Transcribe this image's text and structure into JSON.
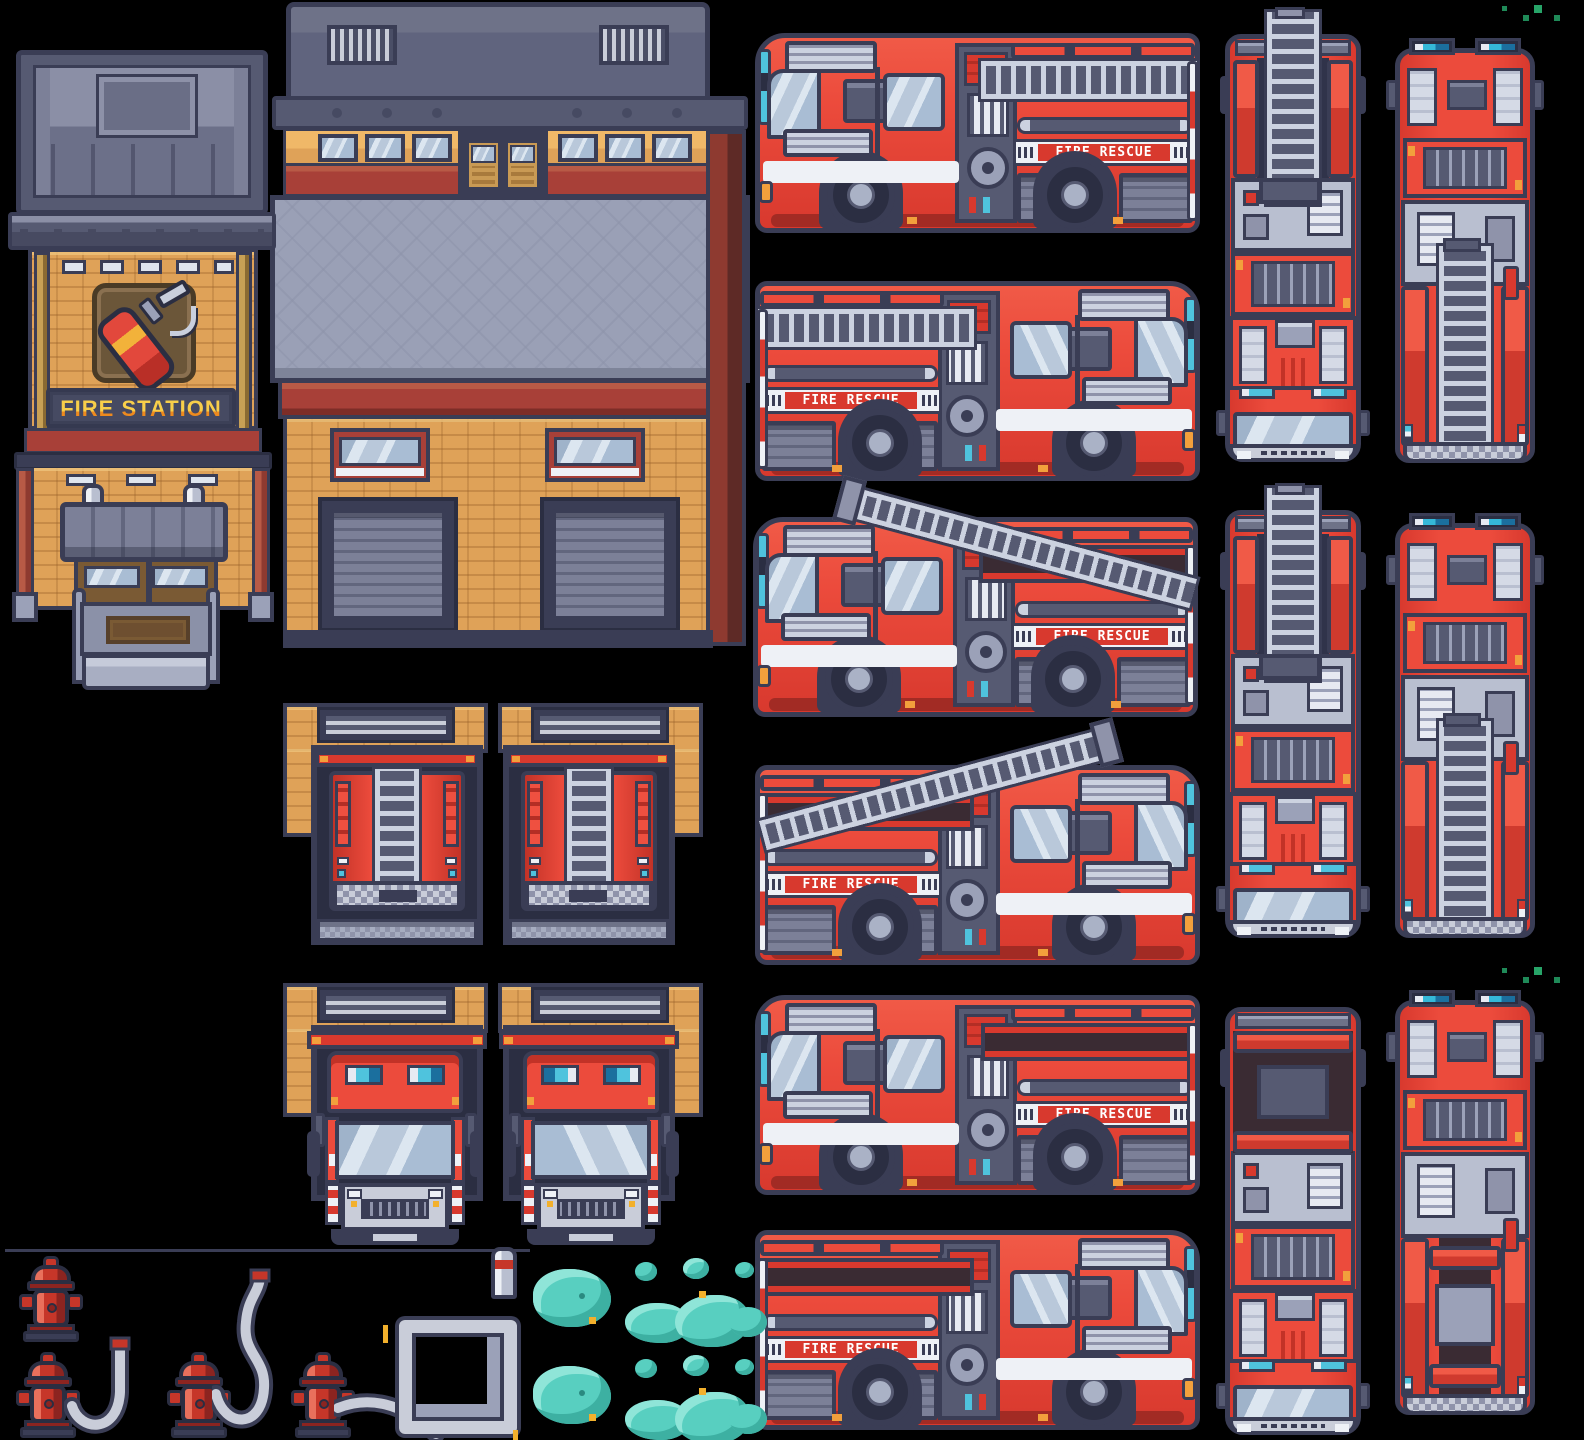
{
  "sheet": {
    "title_visible": false,
    "description": "Pixel-art sprite sheet: fire station building, fire trucks (side and top views), garage doorways with trucks, hydrants, hoses and steam clouds"
  },
  "labels": {
    "station_sign": "FIRE STATION",
    "truck_decal": "FIRE RESCUE"
  },
  "palette": {
    "background": "#000000",
    "outline_navy": "#3a3d55",
    "truck_red": "#ec4b3c",
    "truck_red_dark": "#a22b24",
    "trim_maroon": "#a84038",
    "stripe_white": "#eef1f6",
    "glass_blue": "#b9c8da",
    "ladder_silver": "#ccd2e0",
    "panel_slate": "#6e7288",
    "lightbar_cyan": "#4fc3dd",
    "brick_tan": "#dfa258",
    "roof_gray": "#9aa0b6",
    "sign_text_top": "#f2958a",
    "sign_text_mid": "#f8cf4a",
    "sign_text_bottom": "#ee8a1e",
    "cloud_teal": "#58cfc0",
    "hydrant_red": "#c63629",
    "hose_gray": "#c9cdd9",
    "marker_orange": "#f2a03c",
    "grass_green": "#1f8a58"
  },
  "inventory": {
    "building": [
      "fire-station tower with extinguisher emblem and sign",
      "two-bay garage hall with roller doors"
    ],
    "side_view_trucks": [
      "facing-left ladder stowed",
      "facing-right ladder stowed",
      "facing-left ladder raised",
      "facing-right ladder raised",
      "facing-left empty rack",
      "facing-right empty rack"
    ],
    "top_view_trucks": [
      "heading-down with ladder",
      "heading-up with ladder",
      "heading-down with ladder",
      "heading-up with ladder",
      "heading-down empty rack",
      "heading-up empty rack"
    ],
    "garage_doorways": [
      "truck rear in doorway (left wall)",
      "truck rear in doorway (right wall)",
      "truck front in doorway (left wall)",
      "truck front in doorway (right wall)"
    ],
    "props": [
      "fire hydrant",
      "hydrant with short hose",
      "hydrant with tall S hose",
      "hydrant with long hose",
      "hose nozzle",
      "hose frame outline",
      "steam cloud set x2",
      "grass speck clusters x2",
      "guide line",
      "yellow tick marks"
    ]
  }
}
